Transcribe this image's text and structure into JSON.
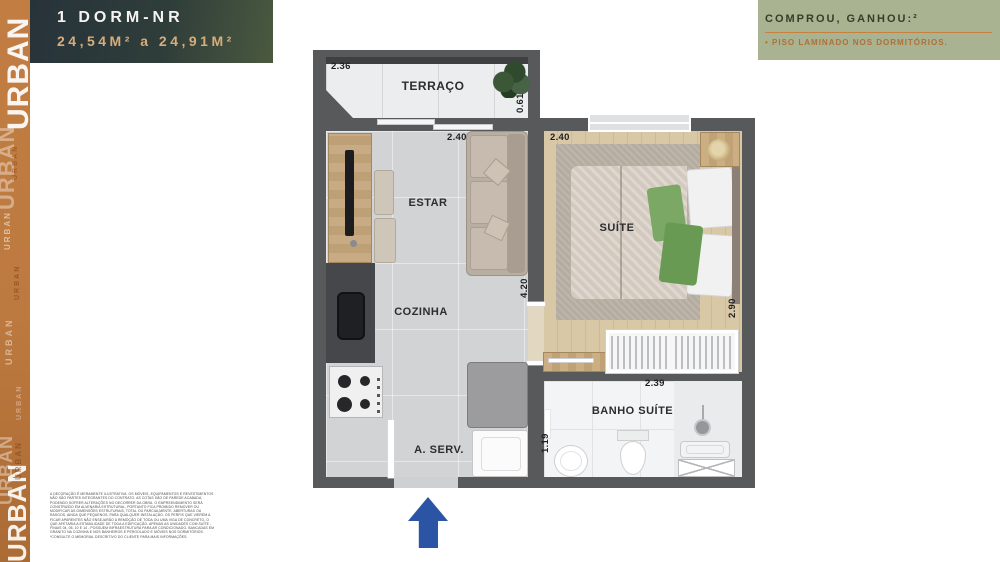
{
  "brand": {
    "name": "URBAN",
    "sidebar_color": "#bd7a40"
  },
  "header": {
    "title": "1 DORM-NR",
    "area_range": "24,54M² a 24,91M²"
  },
  "promo": {
    "title": "COMPROU, GANHOU:²",
    "item": "• PISO LAMINADO NOS DORMITÓRIOS.",
    "accent_color": "#b06f35",
    "bg_color": "#a9b392"
  },
  "plan": {
    "rooms": {
      "terraco": "TERRAÇO",
      "estar": "ESTAR",
      "cozinha": "COZINHA",
      "aserv": "A. SERV.",
      "suite": "SUÍTE",
      "banho": "BANHO SUÍTE"
    },
    "dims": {
      "terraco_w": "2.36",
      "terraco_d": "0.61",
      "estar_w": "2.40",
      "suite_w": "2.40",
      "estar_d": "4.20",
      "suite_d": "2.90",
      "banho_w": "2.39",
      "banho_d": "1.19"
    },
    "wall_color": "#58595b",
    "entry_arrow_color": "#2b55a4"
  },
  "disclaimer": "A DECORAÇÃO É MERAMENTE ILUSTRATIVA. OS MÓVEIS, EQUIPAMENTOS E REVESTIMENTOS NÃO SÃO PARTES INTEGRANTES DO CONTRATO. AS COTAS SÃO DE PAREDE ACABADA, PODENDO SOFRER ALTERAÇÕES NO DECORRER DA OBRA. O EMPREENDIMENTO SERÁ CONSTRUÍDO EM ALVENARIA ESTRUTURAL, PORTANTO FICA PROIBIDO REMOVER OU MODIFICAR AS DIMENSÕES ESTRUTURAIS, TOTAL OU PARCIALMENTE, ABERTURAS OU RASGOS, AINDA QUE PEQUENOS, PARA QUALQUER INSTALAÇÃO, OS PERFIS QUE VIEREM A FICAR APARENTES NÃO ENSEJARÃO A REMOÇÃO DE TODA OU UMA VIGA DE CONCRETO, O QUE AFETARIA A ESTABILIDADE DE TODA A EDIFICAÇÃO. APENAS AS UNIDADES COM SUÍTE - FINAIS 04, 06, 10 E 14 - POSSUEM INFRAESTRUTURA PARA AR CONDICIONADO. BANCADAS EM GRANITO NA COZINHA E NOS BANHEIROS E PERGOLADO E MÓVEIS NOS DORMITÓRIOS. *CONSULTE O MEMORIAL DESCRITIVO DO CLIENTE PARA MAIS INFORMAÇÕES."
}
